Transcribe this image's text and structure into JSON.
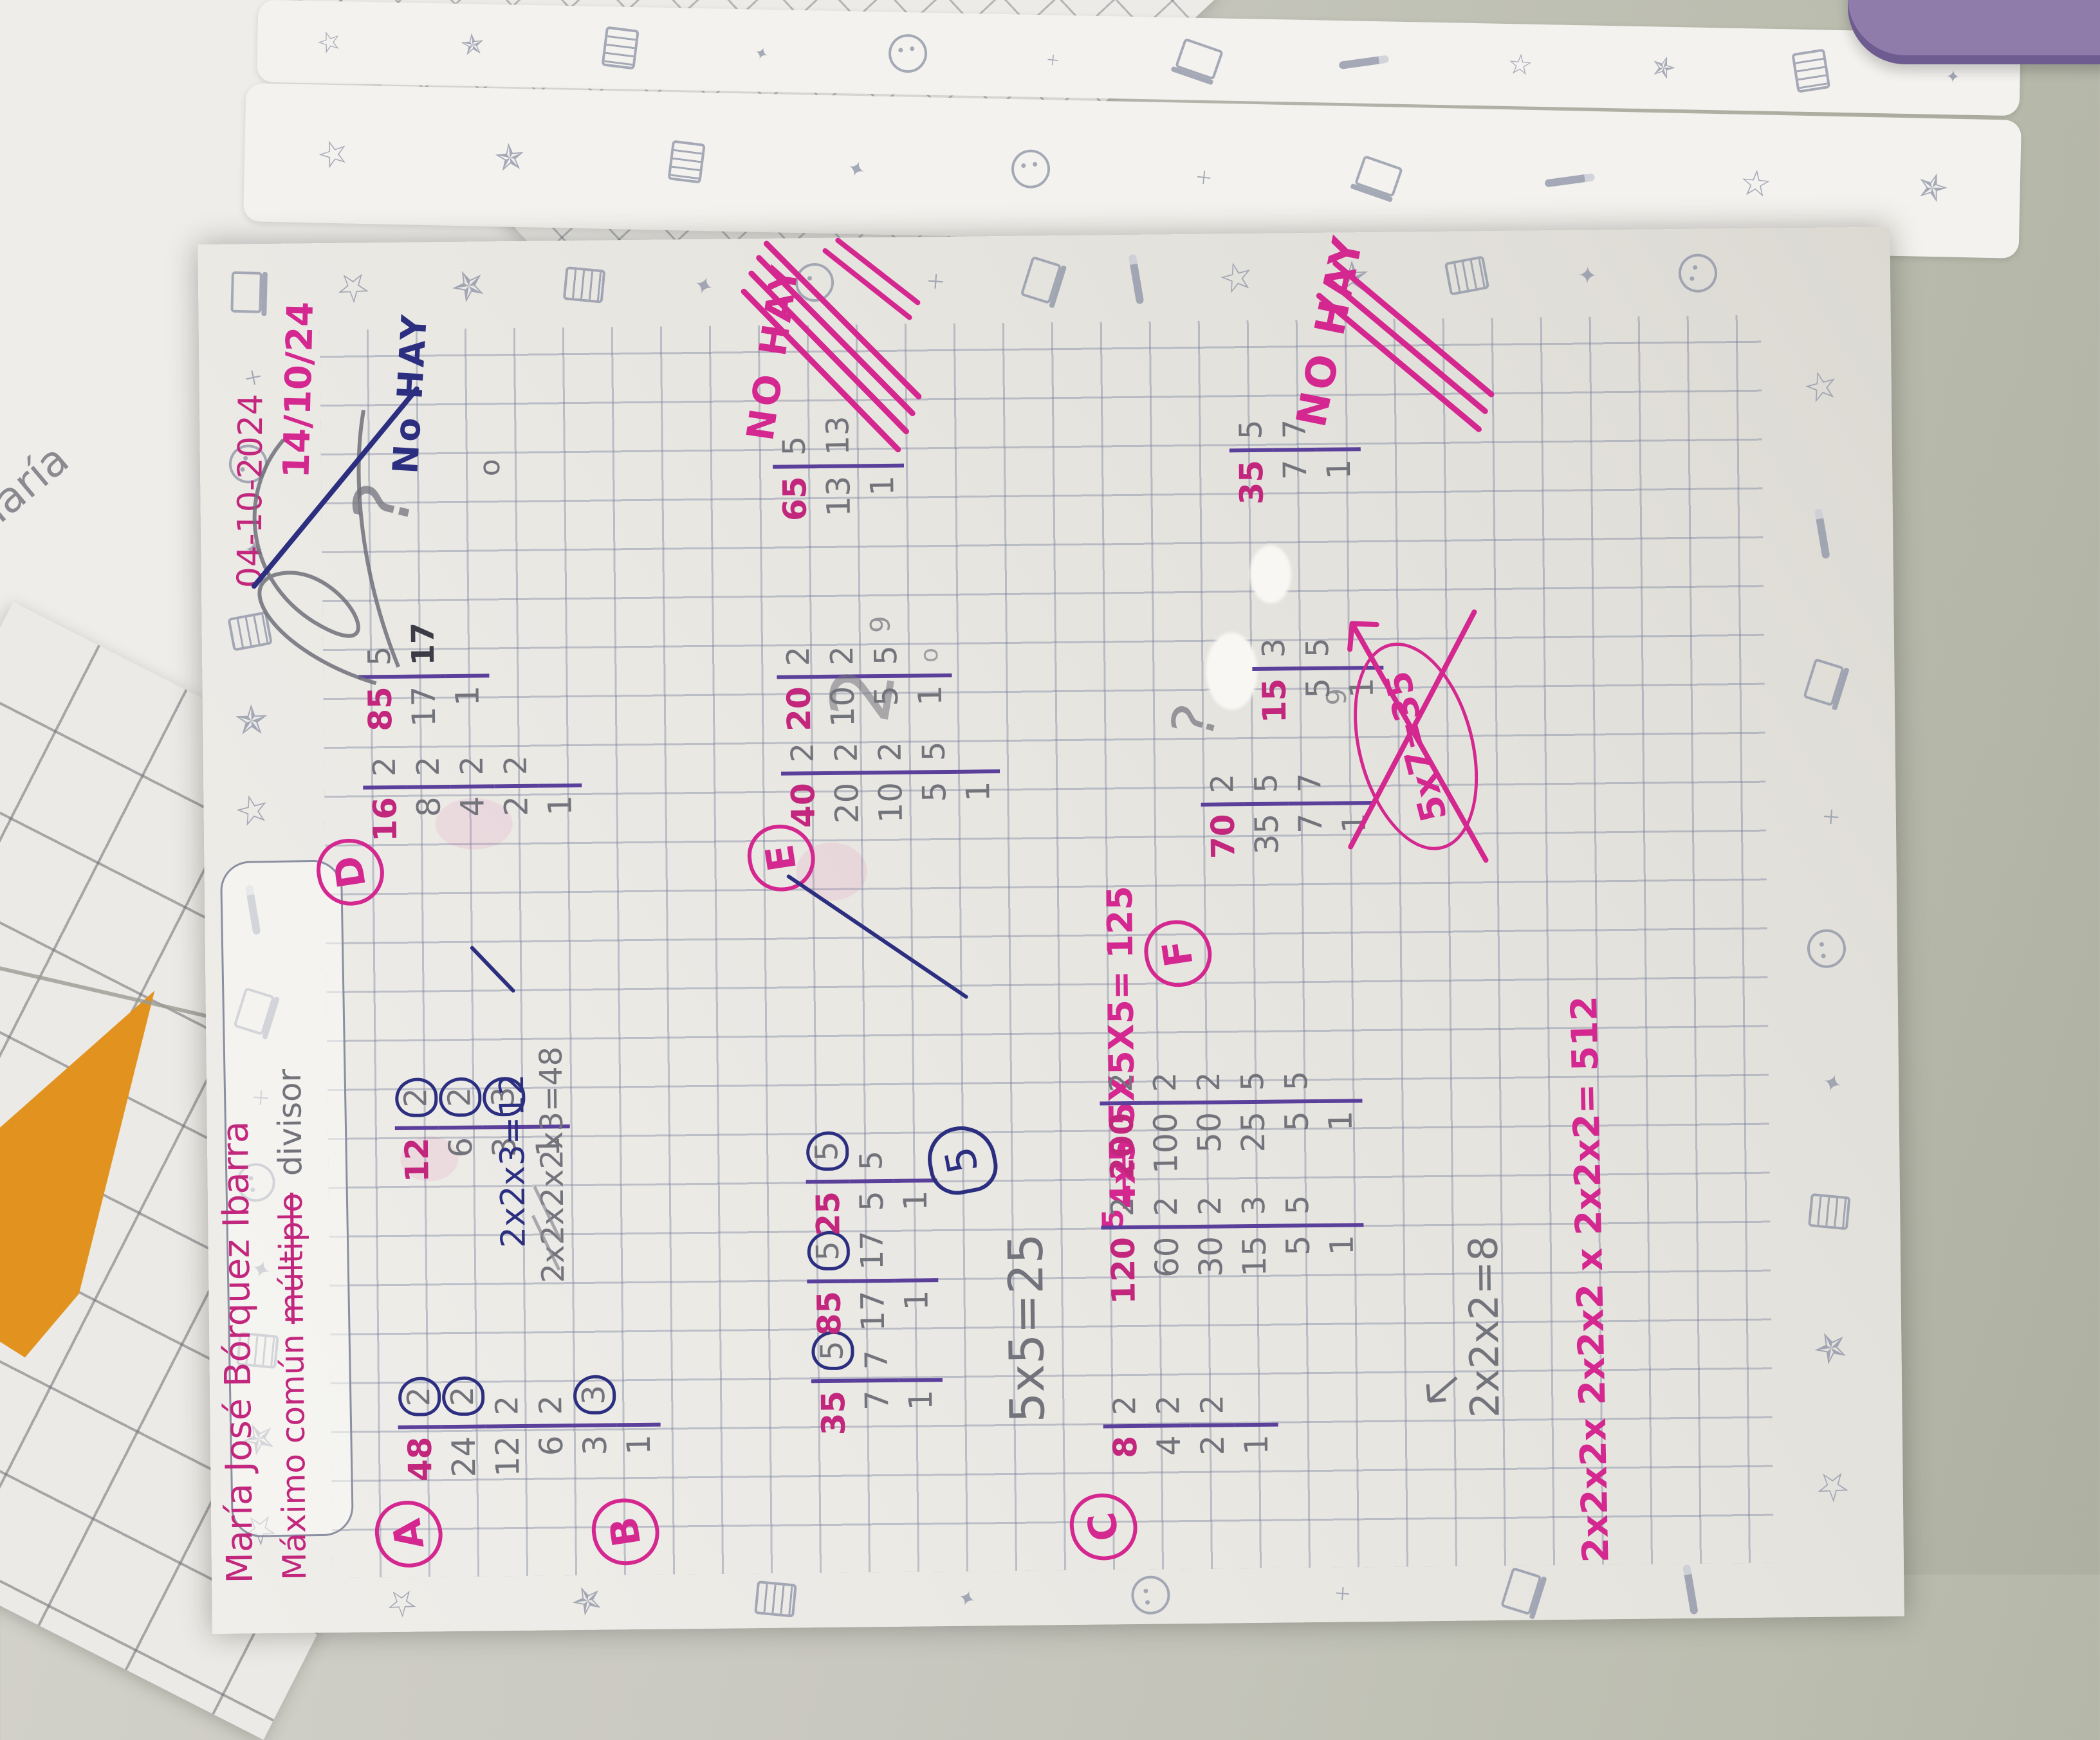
{
  "scene": {
    "desk_color_light": "#d2d1c9",
    "desk_color_dark": "#aeb1a2",
    "orange_paper_color": "#e2921e",
    "purple_object_color": "#8f7cab",
    "background_sheet_lines": [
      "oseciones",
      "nia mucha",
      "zos, barbie-",
      "ces, y",
      "pah.  María",
      "Pob"
    ]
  },
  "page": {
    "student_name": "María José Bórquez Ibarra",
    "header": {
      "prefix": "Máximo común ",
      "struck": "múltiplo",
      "pencil_correction": "divisor"
    },
    "dates": {
      "written": "04-10-2024",
      "marker": "14/10/24"
    },
    "ink_colors": {
      "pink_pen": "#c2267d",
      "pink_marker": "#d4278f",
      "purple_pen": "#5a3f9b",
      "blue_pen": "#2c2f80",
      "pencil": "#73737c"
    },
    "border_icons": [
      "star",
      "shootstar",
      "notebook",
      "sparkle",
      "penguin",
      "plus",
      "laptop",
      "pencil"
    ],
    "exercises": {
      "A": {
        "label": "A",
        "tables": [
          {
            "rows": [
              [
                "48",
                "2",
                1
              ],
              [
                "24",
                "2",
                1
              ],
              [
                "12",
                "2",
                0
              ],
              [
                "6",
                "2",
                0
              ],
              [
                "3",
                "3",
                1
              ],
              [
                "1",
                "",
                0
              ]
            ]
          },
          {
            "rows": [
              [
                "12",
                "2",
                1
              ],
              [
                "6",
                "2",
                1
              ],
              [
                "3",
                "3",
                1
              ],
              [
                "1",
                "",
                0
              ]
            ]
          }
        ],
        "result_ink": "2x2x3=12",
        "result_pencil": "2x2x2x2x3=48"
      },
      "B": {
        "label": "B",
        "tables": [
          {
            "rows": [
              [
                "35",
                "5",
                1
              ],
              [
                "7",
                "7",
                0
              ],
              [
                "1",
                "",
                0
              ]
            ]
          },
          {
            "rows": [
              [
                "85",
                "5",
                1
              ],
              [
                "17",
                "17",
                0
              ],
              [
                "1",
                "",
                0
              ]
            ]
          },
          {
            "rows": [
              [
                "25",
                "5",
                1
              ],
              [
                "5",
                "5",
                0
              ],
              [
                "1",
                "",
                0
              ]
            ]
          }
        ],
        "result_pencil": "5x5=25",
        "circled_answer": "5",
        "correction_struck": "4x5",
        "correction_sup": "5",
        "correction_main": "5X5X5= 125"
      },
      "C": {
        "label": "C",
        "tables": [
          {
            "rows": [
              [
                "8",
                "2",
                0
              ],
              [
                "4",
                "2",
                0
              ],
              [
                "2",
                "2",
                0
              ],
              [
                "1",
                "",
                0
              ]
            ]
          },
          {
            "rows": [
              [
                "120",
                "2",
                0
              ],
              [
                "60",
                "2",
                0
              ],
              [
                "30",
                "2",
                0
              ],
              [
                "15",
                "3",
                0
              ],
              [
                "5",
                "5",
                0
              ],
              [
                "1",
                "",
                0
              ]
            ]
          },
          {
            "rows": [
              [
                "200",
                "2",
                0
              ],
              [
                "100",
                "2",
                0
              ],
              [
                "50",
                "2",
                0
              ],
              [
                "25",
                "5",
                0
              ],
              [
                "5",
                "5",
                0
              ],
              [
                "1",
                "",
                0
              ]
            ]
          }
        ],
        "result_pencil": "2x2x2=8",
        "result_pink": "2x2x2x 2x2x2 x 2x2x2= 512"
      },
      "D": {
        "label": "D",
        "tables": [
          {
            "rows": [
              [
                "16",
                "2",
                0
              ],
              [
                "8",
                "2",
                0
              ],
              [
                "4",
                "2",
                0
              ],
              [
                "2",
                "2",
                0
              ],
              [
                "1",
                "",
                0
              ]
            ]
          },
          {
            "rows": [
              [
                "85",
                "5",
                0
              ],
              [
                "17",
                "17",
                0,
                "dark"
              ],
              [
                "1",
                "",
                0
              ]
            ]
          }
        ],
        "answer_ink": "No HAY",
        "pencil_question": "?",
        "pencil_small": "o"
      },
      "E": {
        "label": "E",
        "tables": [
          {
            "rows": [
              [
                "40",
                "2",
                0
              ],
              [
                "20",
                "2",
                0
              ],
              [
                "10",
                "2",
                0
              ],
              [
                "5",
                "5",
                0
              ],
              [
                "1",
                "",
                0
              ]
            ]
          },
          {
            "rows": [
              [
                "20",
                "2",
                0
              ],
              [
                "10",
                "2",
                0
              ],
              [
                "5",
                "5",
                0
              ],
              [
                "1",
                "",
                0
              ]
            ]
          },
          {
            "rows": [
              [
                "65",
                "5",
                0
              ],
              [
                "13",
                "13",
                0
              ],
              [
                "1",
                "",
                0
              ]
            ]
          }
        ],
        "answer_struck": "NO HAY",
        "pencil_big": "2",
        "pencil_small": "9",
        "pencil_dot": "o"
      },
      "F": {
        "label": "F",
        "tables": [
          {
            "rows": [
              [
                "70",
                "2",
                0
              ],
              [
                "35",
                "5",
                0
              ],
              [
                "7",
                "7",
                0
              ],
              [
                "1",
                "",
                0
              ]
            ]
          },
          {
            "rows": [
              [
                "15",
                "3",
                0
              ],
              [
                "5",
                "5",
                0
              ],
              [
                "1",
                "",
                0
              ]
            ]
          },
          {
            "rows": [
              [
                "35",
                "5",
                0
              ],
              [
                "7",
                "7",
                0
              ],
              [
                "1",
                "",
                0
              ]
            ]
          }
        ],
        "crossed_result": "5x7=35",
        "answer_struck": "NO HAY",
        "pencil_question": "?",
        "pencil_small": "9"
      }
    }
  }
}
